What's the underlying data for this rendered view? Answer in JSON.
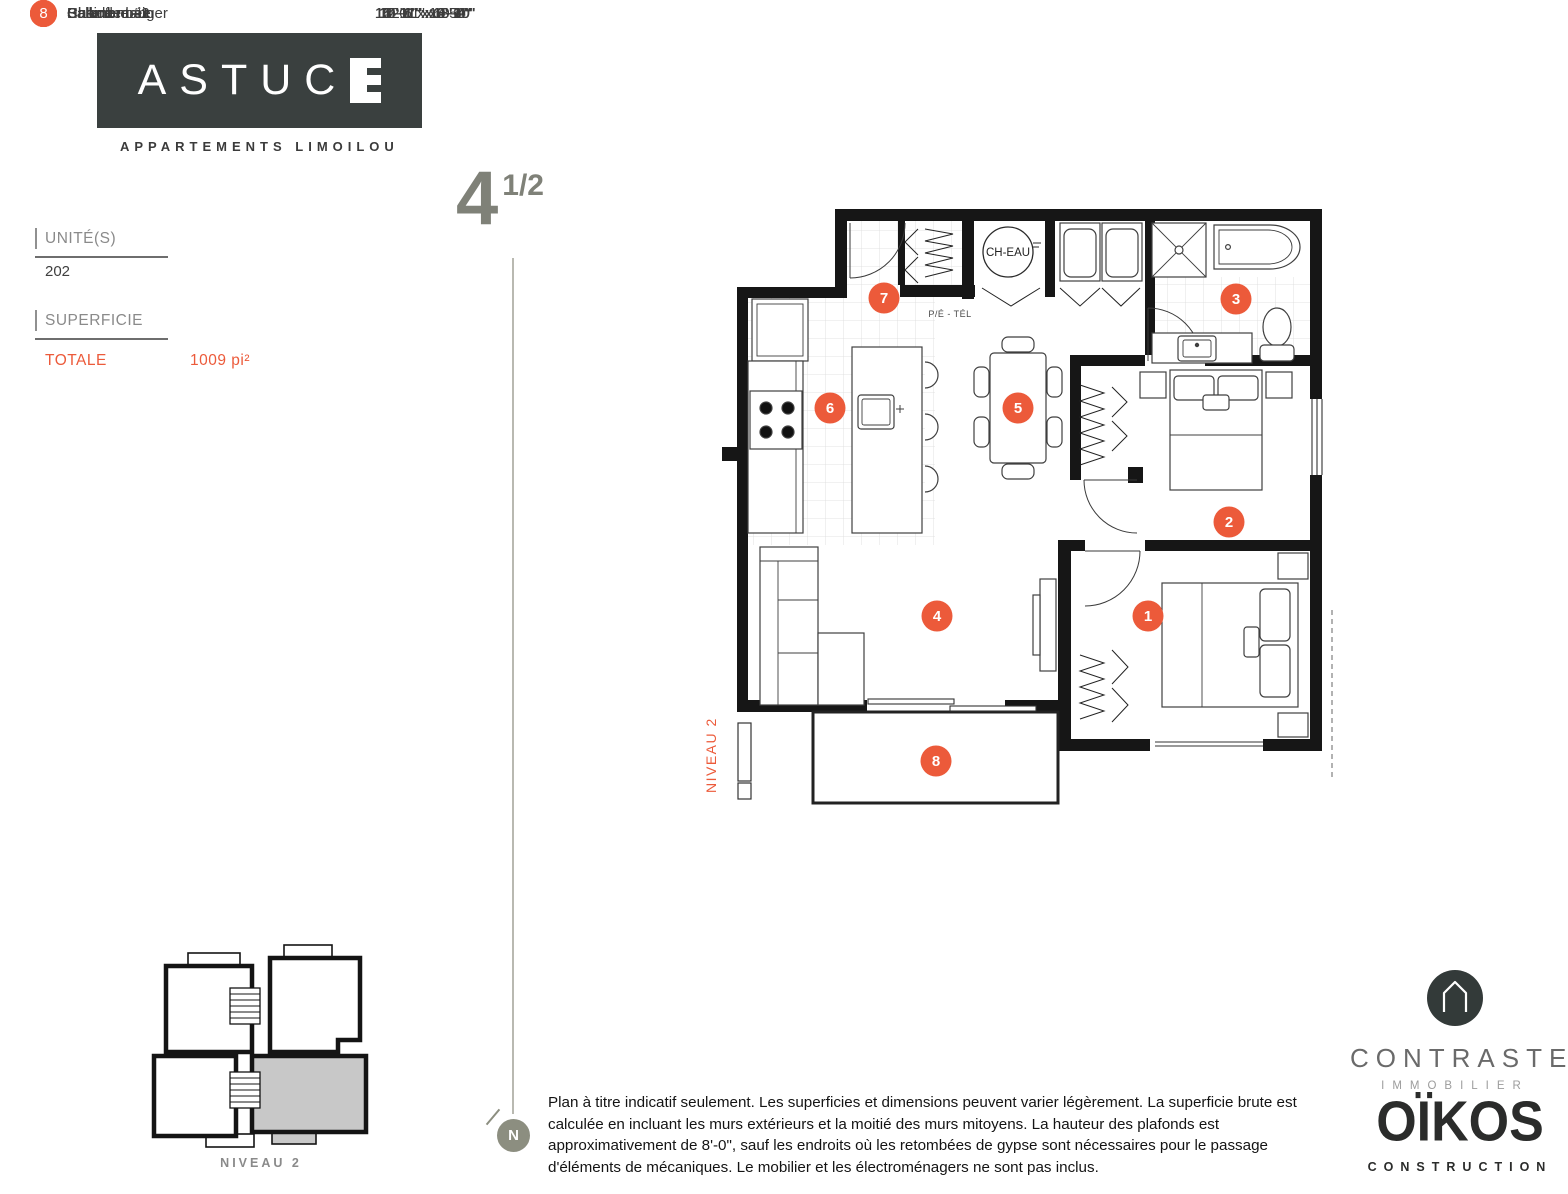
{
  "brand": {
    "name_main": "ASTUC",
    "name_last": "E",
    "subtitle": "APPARTEMENTS LIMOILOU"
  },
  "unit_type": {
    "whole": "4",
    "fraction": "1/2"
  },
  "info": {
    "unit_label": "UNITÉ(S)",
    "unit_value": "202",
    "area_label": "SUPERFICIE",
    "area_total_label": "TOTALE",
    "area_total_value": "1009 pi²"
  },
  "rooms": [
    {
      "number": "1",
      "name": "Chambre #1",
      "dimensions": "12'-6\" x 10'-4\""
    },
    {
      "number": "2",
      "name": "Chambre #2",
      "dimensions": "10'-6\" x 10'-0\""
    },
    {
      "number": "3",
      "name": "Salle de bain",
      "dimensions": "14'-11\" x 8'-9\""
    },
    {
      "number": "4",
      "name": "Salon",
      "dimensions": "13'-11\" x 8'-10\""
    },
    {
      "number": "5",
      "name": "Salle à manger",
      "dimensions": "14'-1\" x 10'-10\""
    },
    {
      "number": "6",
      "name": "Cusine",
      "dimensions": "12'-1\" x 9'-2\""
    },
    {
      "number": "7",
      "name": "Hall d'entrée",
      "dimensions": "5'-1\" x 6'-5\""
    },
    {
      "number": "8",
      "name": "Balcon",
      "dimensions": "5'-0\" x 14'-6\""
    }
  ],
  "plan": {
    "water_heater_label": "CH-EAU",
    "pe_tel_label": "P/É - TÉL",
    "level_label": "NIVEAU 2"
  },
  "key_plan": {
    "caption": "NIVEAU 2"
  },
  "compass": {
    "label": "N"
  },
  "disclaimer": "Plan à titre indicatif seulement. Les superficies et dimensions peuvent varier légèrement. La superficie brute est calculée en incluant les murs extérieurs et la moitié des murs mitoyens. La hauteur des plafonds est approximativement de 8'-0\", sauf les endroits où les retombées de gypse sont nécessaires pour le passage d'éléments de mécaniques. Le mobilier et les électroménagers ne sont pas inclus.",
  "logos": {
    "contraste": {
      "name": "CONTRASTE",
      "subtitle": "IMMOBILIER"
    },
    "oikos": {
      "name": "OÏKOS",
      "subtitle": "CONSTRUCTION"
    }
  },
  "colors": {
    "accent": "#EC5A3A",
    "brand_dark": "#3A403F",
    "text_gray": "#8A8A8A",
    "title_gray": "#7F8178"
  }
}
